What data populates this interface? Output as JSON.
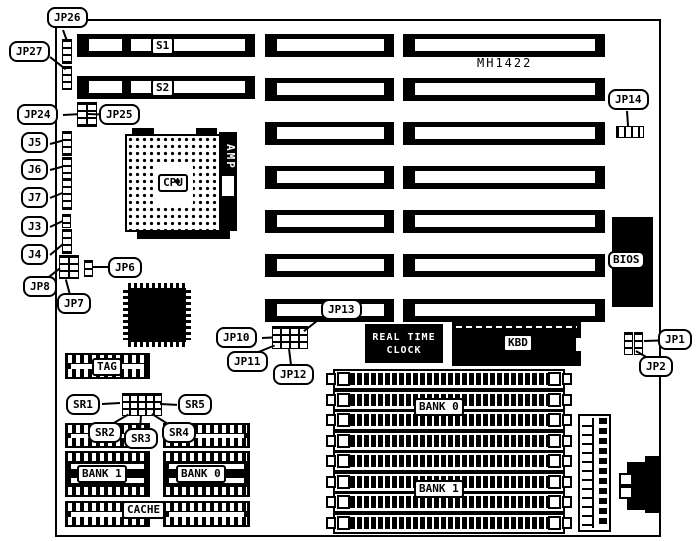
{
  "board": {
    "model": "MH1422"
  },
  "callouts": {
    "jp26": "JP26",
    "jp27": "JP27",
    "jp24": "JP24",
    "jp25": "JP25",
    "j5": "J5",
    "j6": "J6",
    "j7": "J7",
    "j3": "J3",
    "j4": "J4",
    "jp8": "JP8",
    "jp7": "JP7",
    "jp6": "JP6",
    "jp10": "JP10",
    "jp11": "JP11",
    "jp12": "JP12",
    "jp13": "JP13",
    "jp14": "JP14",
    "jp1": "JP1",
    "jp2": "JP2",
    "sr1": "SR1",
    "sr2": "SR2",
    "sr3": "SR3",
    "sr4": "SR4",
    "sr5": "SR5"
  },
  "slots": {
    "s1": "S1",
    "s2": "S2"
  },
  "chips": {
    "cpu": "CPU",
    "amp": "AMP",
    "bios": "BIOS",
    "kbd": "KBD",
    "rtc_line1": "REAL TIME",
    "rtc_line2": "CLOCK",
    "tag": "TAG"
  },
  "memory": {
    "cache_dip_bank1": "BANK 1",
    "cache_dip_bank0": "BANK 0",
    "cache_label": "CACHE",
    "simm_bank0": "BANK 0",
    "simm_bank1": "BANK 1"
  },
  "colors": {
    "ink": "#000000",
    "paper": "#ffffff"
  }
}
